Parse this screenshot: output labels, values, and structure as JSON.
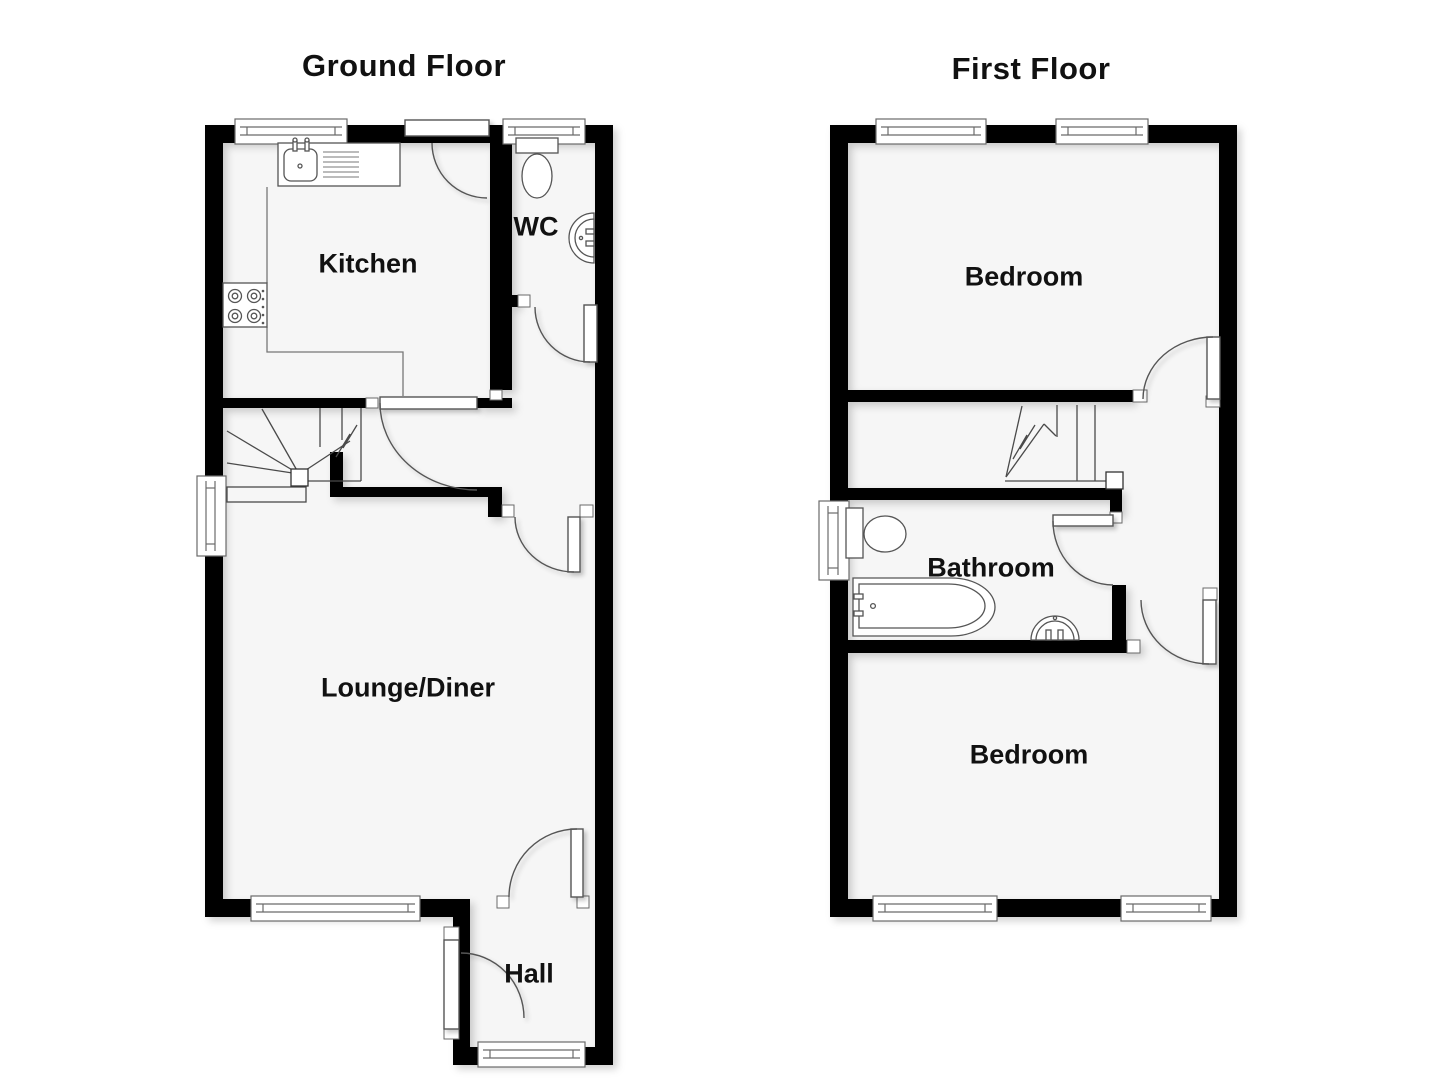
{
  "plan": {
    "type": "floorplan",
    "floors": [
      {
        "id": "ground",
        "title": "Ground Floor",
        "rooms": [
          {
            "id": "kitchen",
            "label": "Kitchen",
            "fixtures": [
              "sink-drainer",
              "hob"
            ]
          },
          {
            "id": "wc",
            "label": "WC",
            "fixtures": [
              "toilet",
              "basin"
            ]
          },
          {
            "id": "lounge-diner",
            "label": "Lounge/Diner",
            "fixtures": []
          },
          {
            "id": "hall",
            "label": "Hall",
            "fixtures": [
              "front-door"
            ]
          }
        ],
        "features": [
          "winder-staircase",
          "back-door",
          "4-windows",
          "5-internal-doors"
        ]
      },
      {
        "id": "first",
        "title": "First Floor",
        "rooms": [
          {
            "id": "bedroom-front",
            "label": "Bedroom",
            "fixtures": []
          },
          {
            "id": "bathroom",
            "label": "Bathroom",
            "fixtures": [
              "toilet",
              "bath",
              "basin"
            ]
          },
          {
            "id": "bedroom-back",
            "label": "Bedroom",
            "fixtures": []
          }
        ],
        "features": [
          "staircase",
          "landing",
          "5-windows",
          "3-internal-doors"
        ]
      }
    ],
    "colors": {
      "wall": "#030303",
      "floor": "#f6f6f6",
      "outline": "#4a4a4a",
      "fixture_line": "#555555",
      "label": "#111111",
      "background": "#ffffff"
    }
  }
}
